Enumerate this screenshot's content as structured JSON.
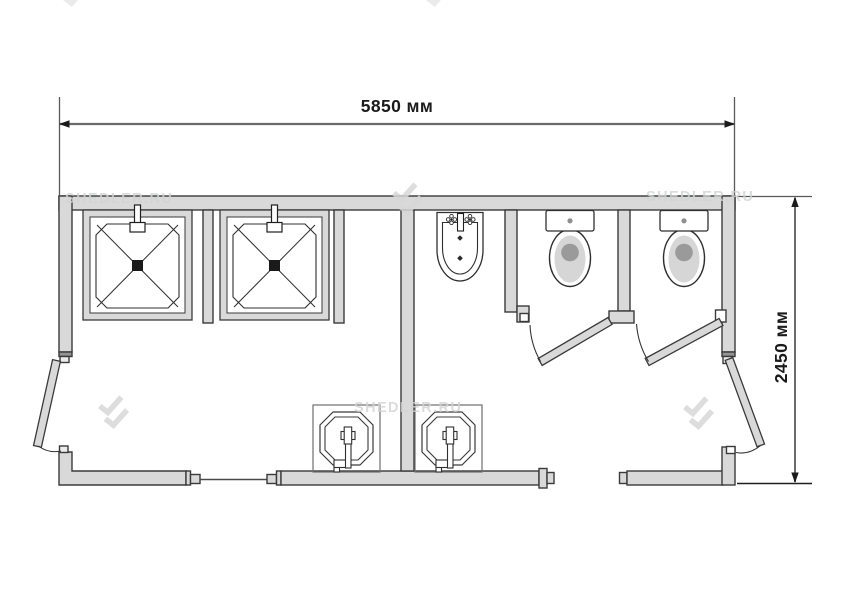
{
  "page": {
    "background": "#ffffff",
    "type": "floor-plan-drawing"
  },
  "dimensions": {
    "width_label": "5850 мм",
    "height_label": "2450 мм"
  },
  "watermark": {
    "text": "SHEDLER.RU",
    "logo": "shedler-double-chevron",
    "color": "#d7d7d7"
  },
  "colors": {
    "wall_fill": "#d9d9d9",
    "outline": "#3a3a3a",
    "jamb_dark": "#949494",
    "dimension_line": "#6a6a6a",
    "dimension_text": "#1b1b1b",
    "bowl_inner_gray": "#d6d6d6",
    "drain_gray": "#9a9a9a",
    "drain_black": "#1a1a1a"
  },
  "fixtures": [
    {
      "name": "shower-tray",
      "count": 2
    },
    {
      "name": "shower-mixer",
      "count": 2
    },
    {
      "name": "wall-hung-washbasin",
      "count": 1
    },
    {
      "name": "toilet",
      "count": 2
    },
    {
      "name": "sink-with-faucet",
      "count": 2
    },
    {
      "name": "exterior-door",
      "count": 2
    },
    {
      "name": "stall-door",
      "count": 2
    },
    {
      "name": "window",
      "count": 1
    }
  ]
}
